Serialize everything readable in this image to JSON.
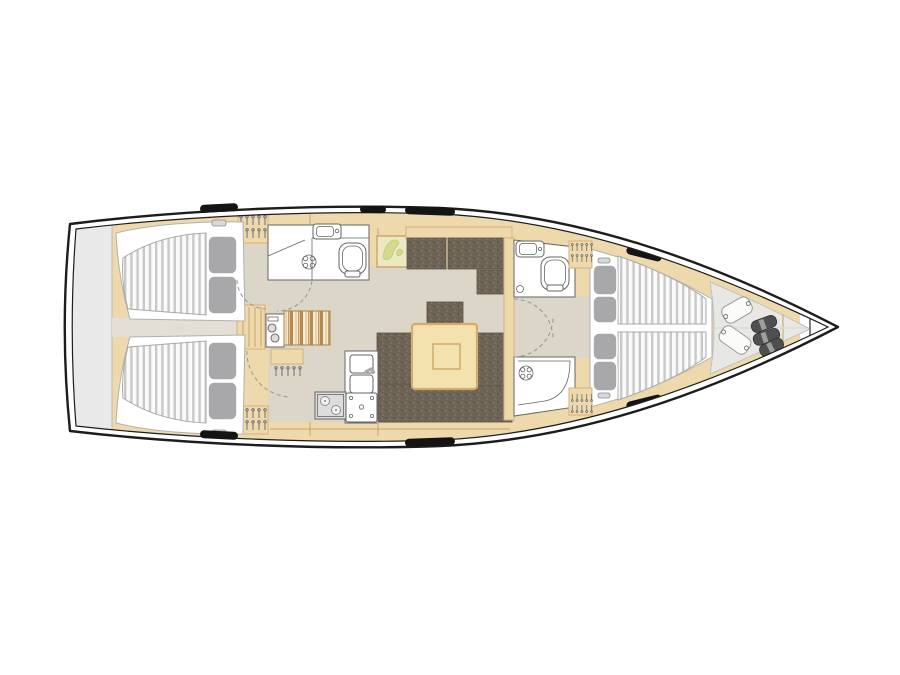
{
  "meta": {
    "type": "sailing-yacht-interior-layout-plan",
    "view": "top-down",
    "bow_direction": "right",
    "visible_text": ""
  },
  "colors": {
    "background": "#ffffff",
    "hull-line": "#1d1d1d",
    "wood": "#eed9ad",
    "wood-border": "#d4b179",
    "wood-seam": "#c9a468",
    "floor": "#dcd6c9",
    "corridor": "#e3dfd6",
    "transom": "#e9e9e9",
    "transom-border": "#bababa",
    "locker-floor": "#e7e7e4",
    "mattress": "#fafafa",
    "mattress-stripe": "#c9c9c9",
    "mattress-border": "#a9a9a9",
    "pillow": "#a8a8aa",
    "fixture-white": "#ffffff",
    "fixture-border": "#666666",
    "frame": "#b0b0b0",
    "steel": "#dcdcdc",
    "sofa": "#6f6557",
    "sofa-dark": "#5a5144",
    "sofa-light": "#827969",
    "table": "#f3e1ae",
    "table-border": "#d5ab6c",
    "table-inner": "#c9a263",
    "seat1": "#b8894f",
    "seat2": "#ecd2a4",
    "seat3": "#f8eed8",
    "map-bg": "#ebe9c2",
    "map-land": "#d5da8b",
    "fender": "#4f4f4f",
    "fender-band": "#9e9e9e",
    "hardware": "#141414",
    "dash": "#9a9a9a",
    "hanger": "#6f6f6f"
  },
  "compartments": [
    {
      "name": "swim-platform",
      "items": [
        "transom-locker"
      ]
    },
    {
      "name": "aft-cabin-port",
      "items": [
        "double-berth",
        "two-pillows",
        "wardrobe-hangers"
      ]
    },
    {
      "name": "aft-cabin-starboard",
      "items": [
        "double-berth",
        "two-pillows",
        "wardrobe-hangers"
      ]
    },
    {
      "name": "companionway",
      "items": [
        "steps",
        "corridor"
      ]
    },
    {
      "name": "aft-head",
      "items": [
        "washbasin",
        "toilet",
        "shower-drain",
        "door-swing"
      ]
    },
    {
      "name": "nav-station",
      "items": [
        "instrument-panel",
        "striped-seat",
        "desk",
        "hangers"
      ]
    },
    {
      "name": "galley",
      "items": [
        "double-sink",
        "faucet",
        "two-burner-stove",
        "oven"
      ]
    },
    {
      "name": "saloon",
      "items": [
        "side-sofa",
        "u-shaped-sofa",
        "dining-table",
        "framed-chart"
      ]
    },
    {
      "name": "forward-head",
      "items": [
        "washbasin",
        "toilet",
        "separate-shower",
        "door-swings"
      ]
    },
    {
      "name": "forward-cabin",
      "items": [
        "v-berth",
        "four-pillows",
        "wardrobe-hangers"
      ]
    },
    {
      "name": "sail-locker",
      "items": [
        "sail-bag",
        "sail-bag",
        "fender",
        "fender",
        "fender"
      ]
    }
  ]
}
